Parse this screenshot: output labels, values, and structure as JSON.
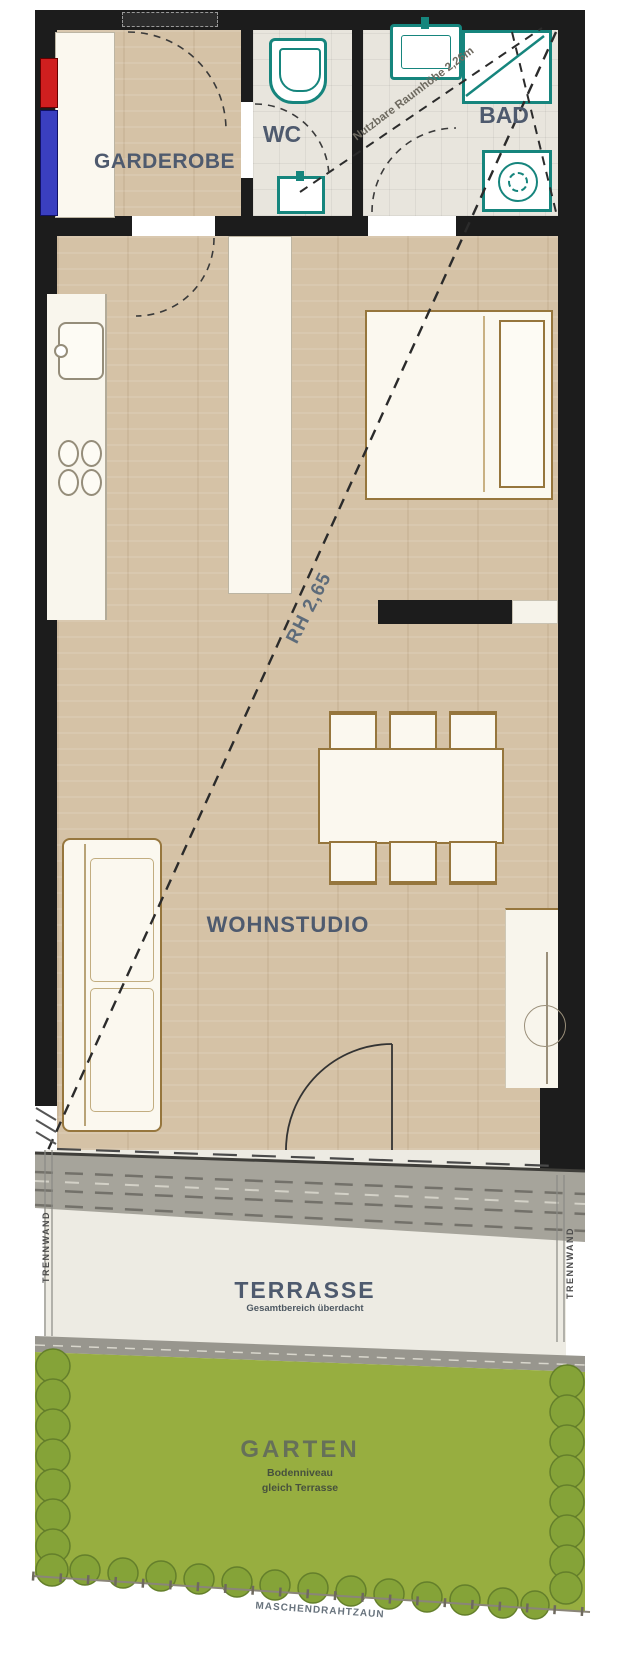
{
  "colors": {
    "wall": "#1c1c1c",
    "wood": "#d5c2a6",
    "tile": "#e8e5dd",
    "furn": "#fbf8ef",
    "furnline": "#96763d",
    "teal": "#16857d",
    "label": "#4e5a6e",
    "grass": "#97ae40",
    "terrace": "#edebe3",
    "riserred": "#d01f1f",
    "riserblue": "#3a3fc0",
    "note": "#5d6b7a"
  },
  "rooms": {
    "garderobe": {
      "label": "GARDEROBE"
    },
    "wc": {
      "label": "WC"
    },
    "bad": {
      "label": "BAD"
    },
    "wohnstudio": {
      "label": "WOHNSTUDIO"
    },
    "terrasse": {
      "label": "TERRASSE",
      "subtitle": "Gesamtbereich überdacht"
    },
    "garten": {
      "label": "GARTEN",
      "subtitle_line1": "Bodenniveau",
      "subtitle_line2": "gleich Terrasse"
    }
  },
  "annotations": {
    "rh_main": "RH 2,65",
    "rh_sloped": "Nutzbare Raumhöhe 2,26m",
    "partition_left": "TRENNWAND",
    "partition_right": "TRENNWAND",
    "fence": "MASCHENDRAHTZAUN"
  }
}
